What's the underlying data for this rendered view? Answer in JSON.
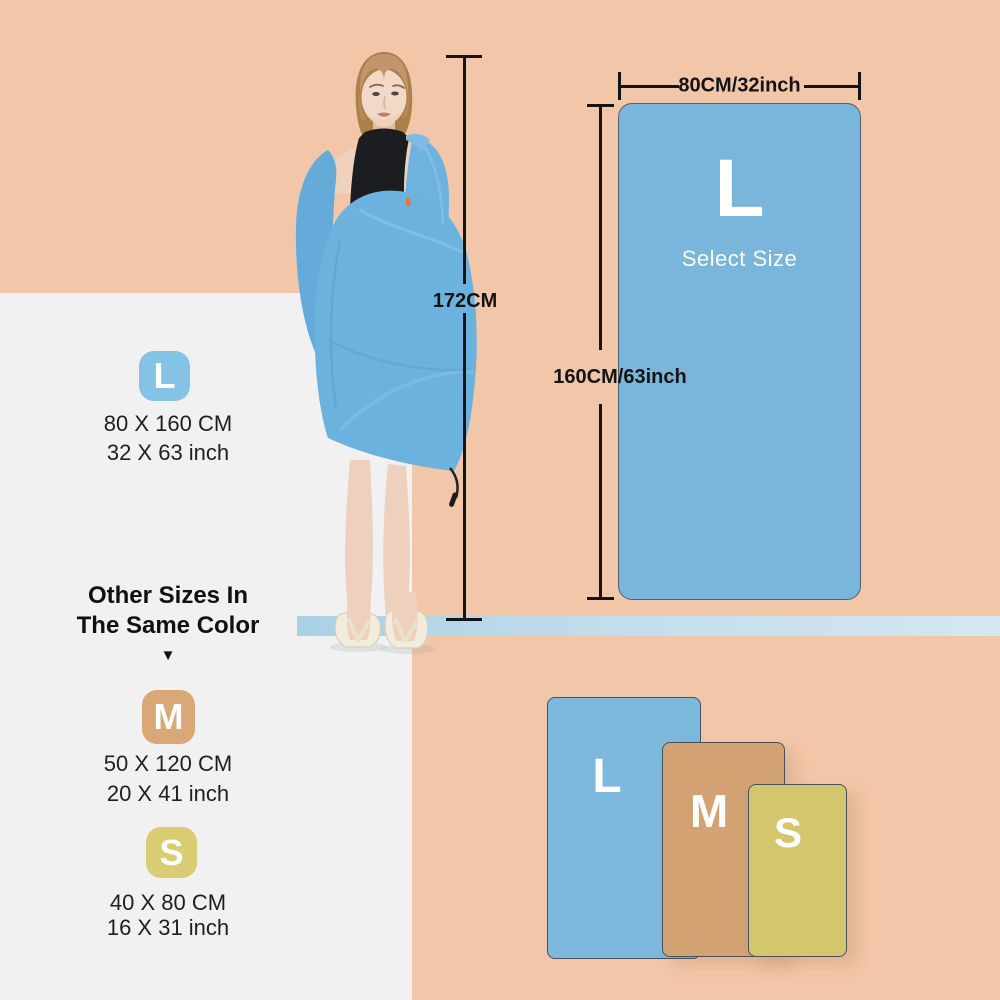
{
  "model_figure": {
    "height_label": "172CM"
  },
  "size_diagram": {
    "width_label": "80CM/32inch",
    "height_label": "160CM/63inch",
    "size_letter": "L",
    "select_label": "Select Size"
  },
  "size_list": {
    "heading_line1": "Other Sizes In",
    "heading_line2": "The Same Color",
    "arrow_icon": "▼",
    "items": [
      {
        "letter": "L",
        "cm": "80 X 160 CM",
        "inch": "32 X 63 inch",
        "color": "#85C3E6"
      },
      {
        "letter": "M",
        "cm": "50 X 120 CM",
        "inch": "20 X 41 inch",
        "color": "#D9A876"
      },
      {
        "letter": "S",
        "cm": "40 X 80 CM",
        "inch": "16 X 31 inch",
        "color": "#DACC72"
      }
    ]
  },
  "size_comparison": {
    "items": [
      {
        "letter": "L",
        "color": "#7CB9DD"
      },
      {
        "letter": "M",
        "color": "#D3A273"
      },
      {
        "letter": "S",
        "color": "#D4C66D"
      }
    ]
  },
  "palette": {
    "background": "#F2C6A8",
    "panel": "#F1F1F2",
    "towel_blue": "#7AB6DB",
    "shelf_strip": "#C3DDEC",
    "measure_line": "#141414",
    "text": "#161616"
  }
}
